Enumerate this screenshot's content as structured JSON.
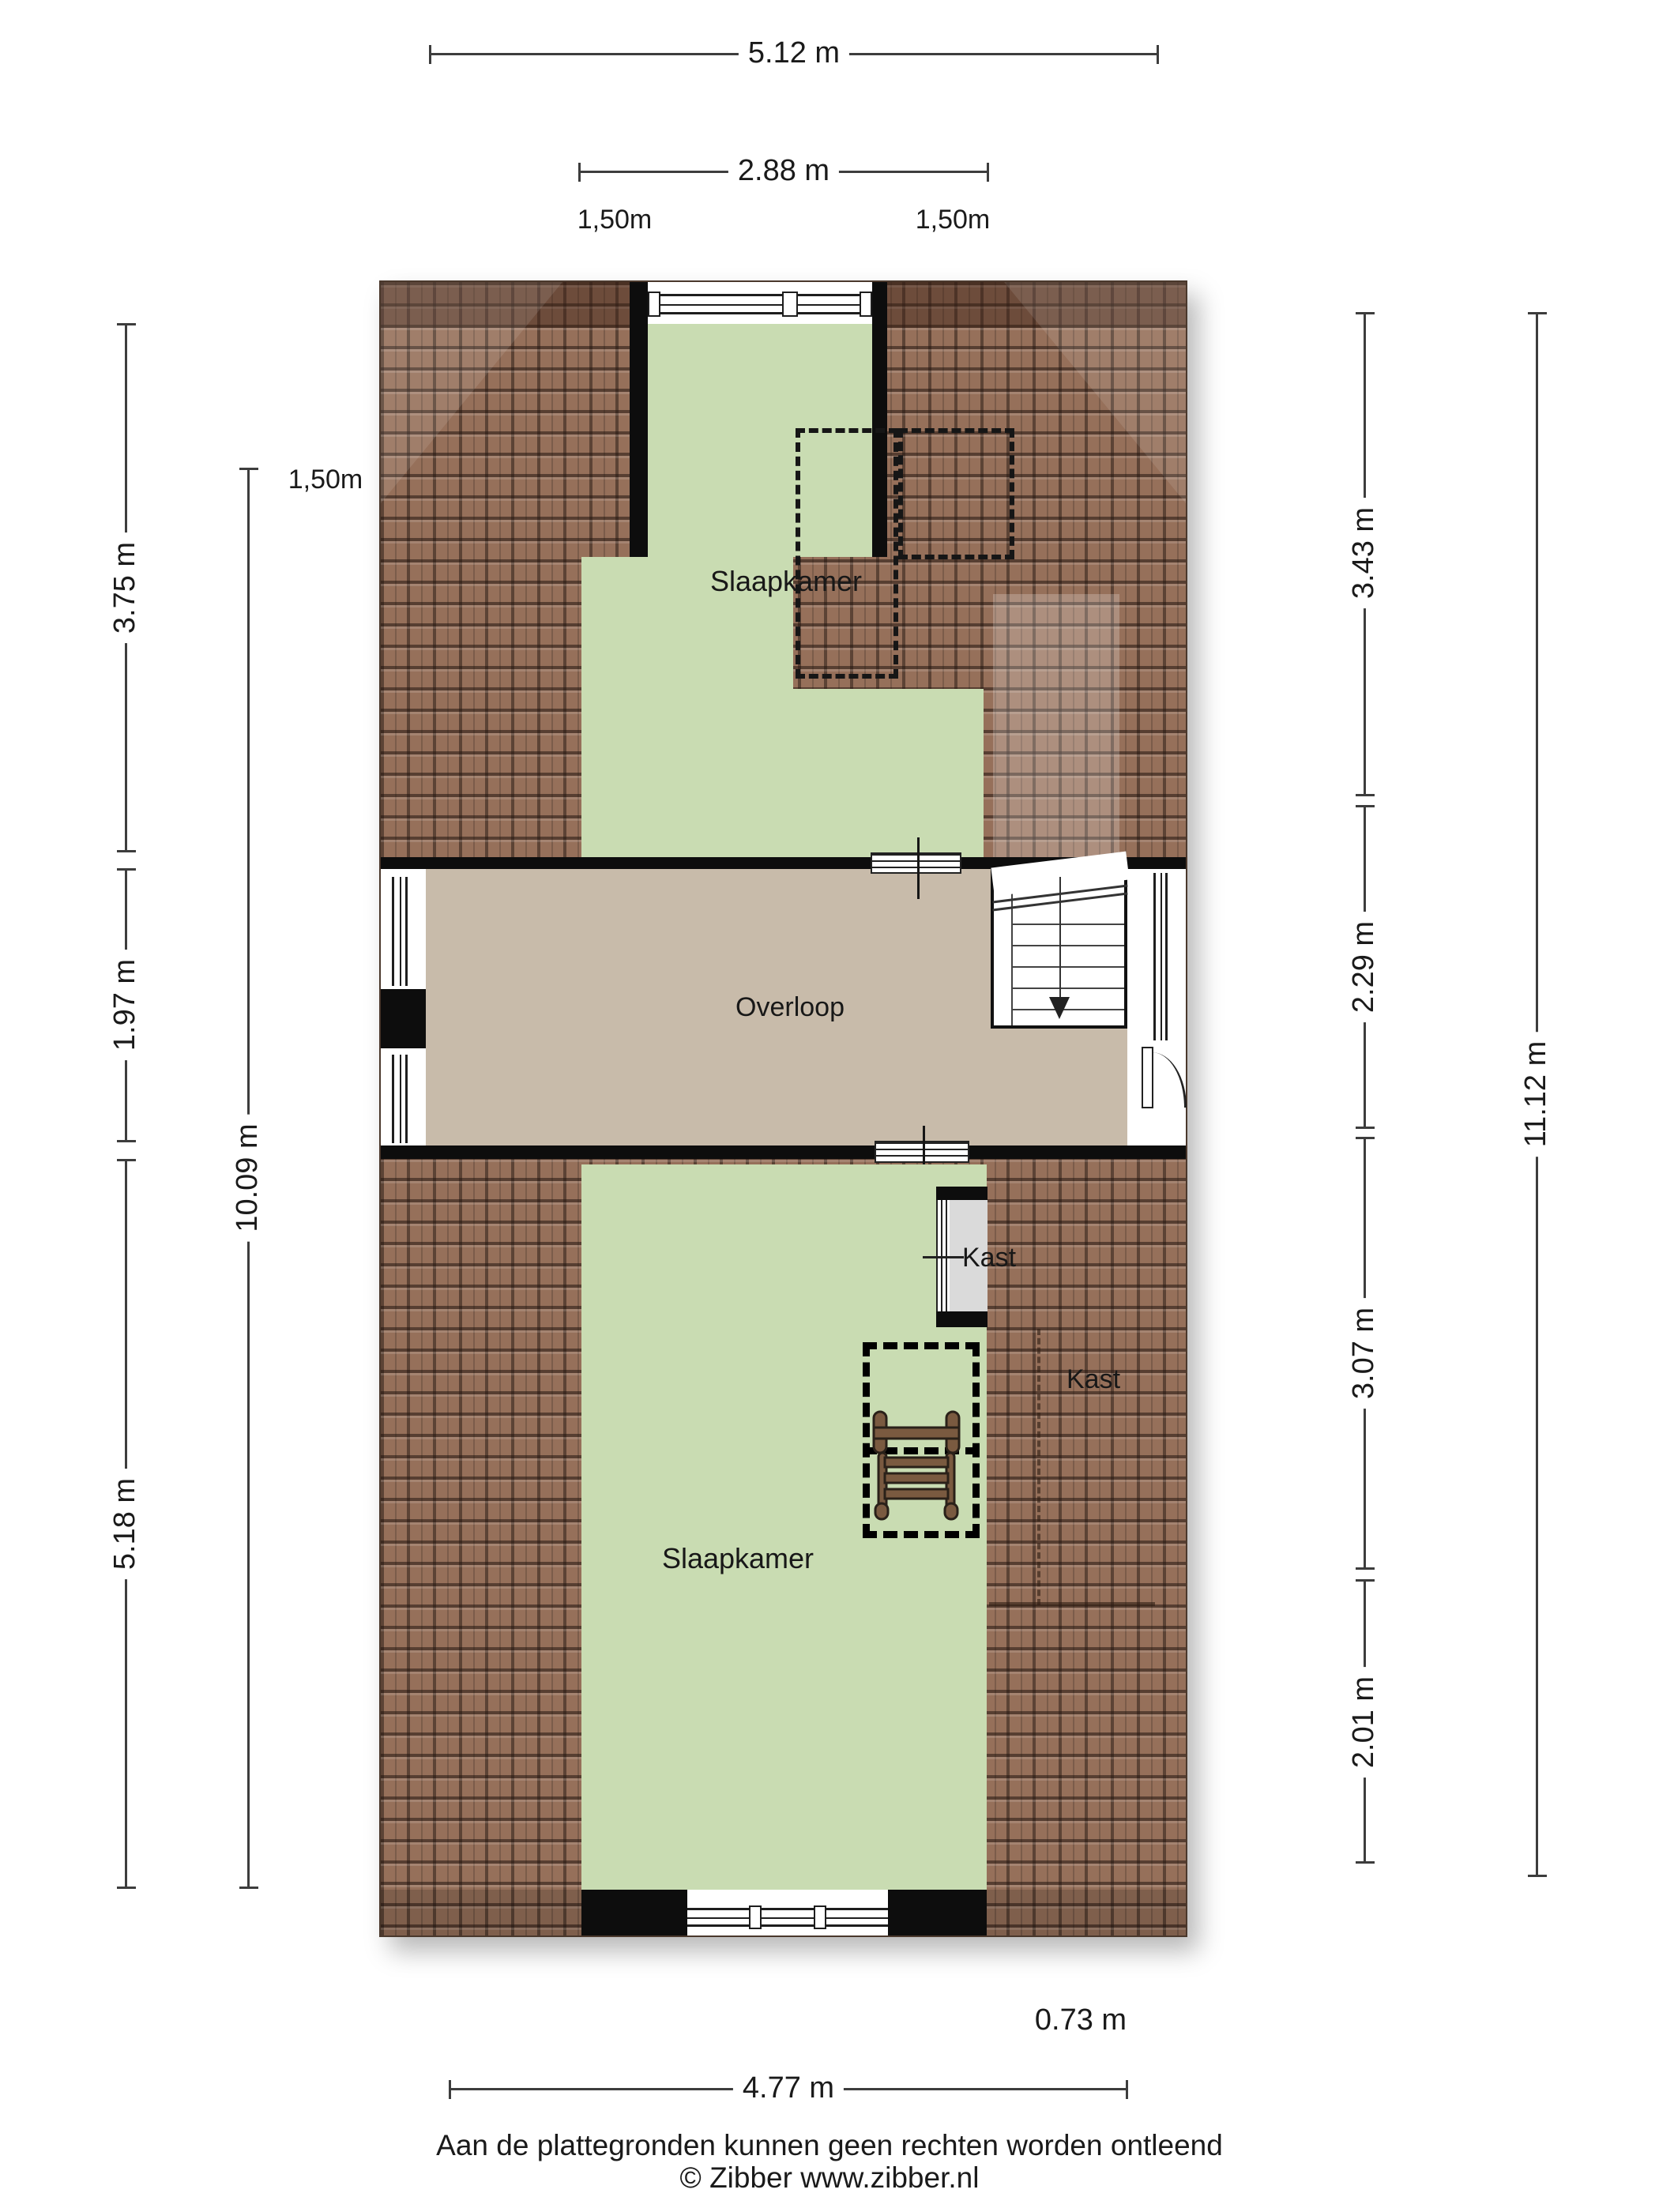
{
  "title": "Plattegrond verdieping",
  "colors": {
    "room_green": "#c9dcb2",
    "hall_beige": "#c8bbaa",
    "roof_brown": "#96705a",
    "closet_grey": "#dadada",
    "wall_black": "#0d0d0d"
  },
  "rooms": {
    "bedroom_top": "Slaapkamer",
    "landing": "Overloop",
    "bedroom_bottom": "Slaapkamer",
    "closet_small": "Kast",
    "closet_under_roof": "Kast"
  },
  "dimensions": {
    "top_width": "5.12 m",
    "top_inner_width": "2.88 m",
    "headroom_top_left": "1,50m",
    "headroom_top_right": "1,50m",
    "headroom_side": "1,50m",
    "left_top": "3.75 m",
    "left_middle": "1.97 m",
    "left_bottom": "5.18 m",
    "left_total": "10.09 m",
    "right_1": "3.43 m",
    "right_2": "2.29 m",
    "right_3": "3.07 m",
    "right_4": "2.01 m",
    "right_total": "11.12 m",
    "bottom_offset": "0.73 m",
    "bottom_width": "4.77 m"
  },
  "footer": {
    "disclaimer": "Aan de plattegronden kunnen geen rechten worden ontleend",
    "credit": "© Zibber www.zibber.nl"
  }
}
